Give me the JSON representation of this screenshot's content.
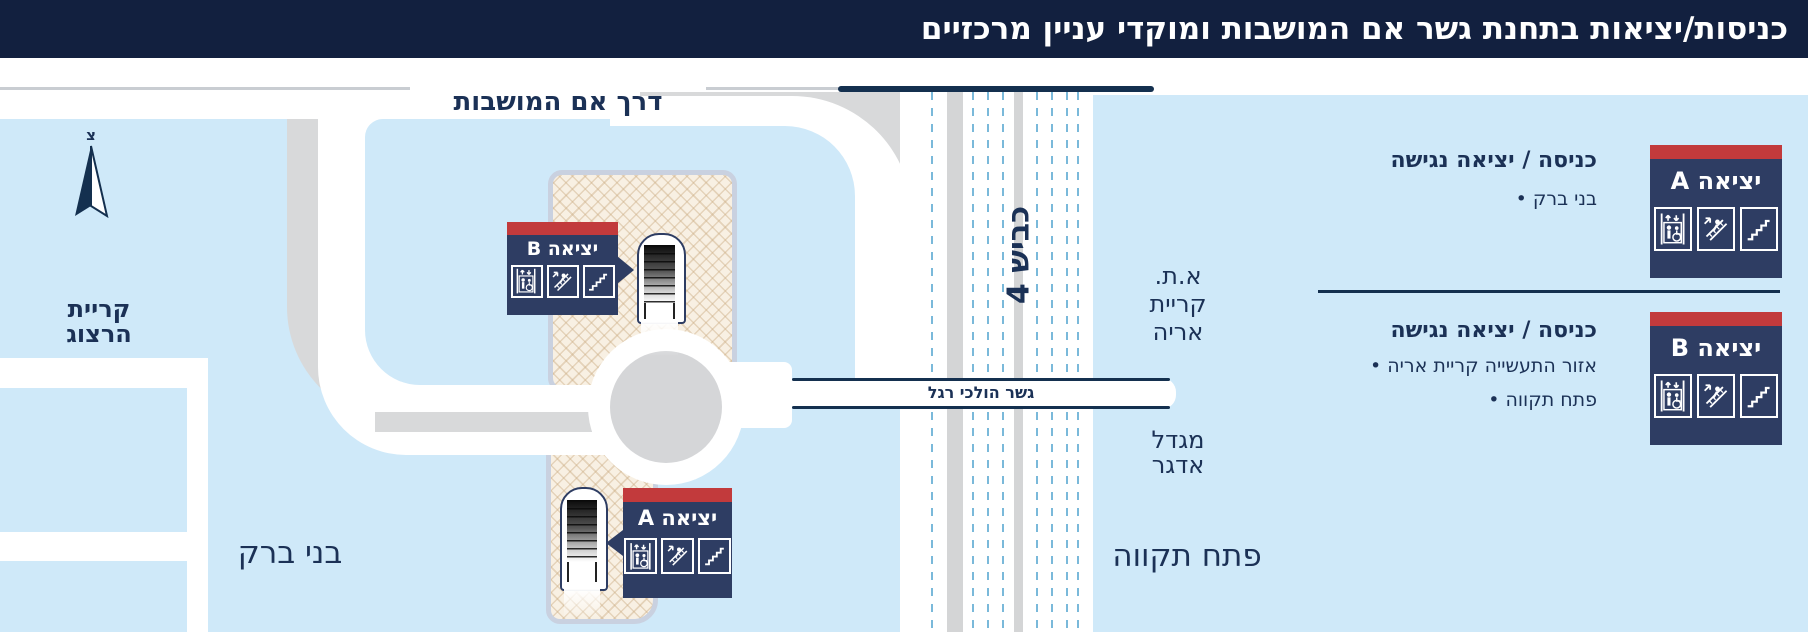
{
  "title": "כניסות/יציאות בתחנת גשר אם המושבות ומוקדי עניין מרכזיים",
  "bullet_char": "•",
  "colors": {
    "title_navy": "#12203f",
    "text_navy": "#1b3156",
    "sign_navy": "#2e3d63",
    "sign_red": "#c23a3c",
    "background_blue": "#cfe9f9",
    "road_gray": "#d8d9da",
    "plaza_beige": "#f8f0e3",
    "plaza_border": "#c9d1e0",
    "lane_dash_blue": "#7ab9da"
  },
  "north": {
    "letter": "צ"
  },
  "roads": {
    "em_hamoshavot": "דרך אם המושבות",
    "route4": "כביש 4",
    "footbridge": "גשר הולכי רגל"
  },
  "areas": {
    "kiryat_herzog": {
      "line1": "קריית",
      "line2": "הרצוג"
    },
    "bnei_brak": "בני ברק",
    "at_kiryat_arye": {
      "line1": "א.ת.",
      "line2": "קריית",
      "line3": "אריה"
    },
    "migdal_adgar": {
      "line1": "מגדל",
      "line2": "אדגר"
    },
    "petah_tikva": "פתח תקווה"
  },
  "map_exits": {
    "a": {
      "sign": "יציאה A"
    },
    "b": {
      "sign": "יציאה B"
    }
  },
  "legend": {
    "a": {
      "sign": "יציאה A",
      "heading": "כניסה / יציאה נגישה",
      "bullets": [
        "בני ברק"
      ]
    },
    "b": {
      "sign": "יציאה B",
      "heading": "כניסה / יציאה נגישה",
      "bullets": [
        "אזור התעשייה קריית אריה",
        "פתח תקווה"
      ]
    }
  },
  "icon_names": [
    "elevator-icon",
    "escalator-icon",
    "stairs-icon"
  ]
}
